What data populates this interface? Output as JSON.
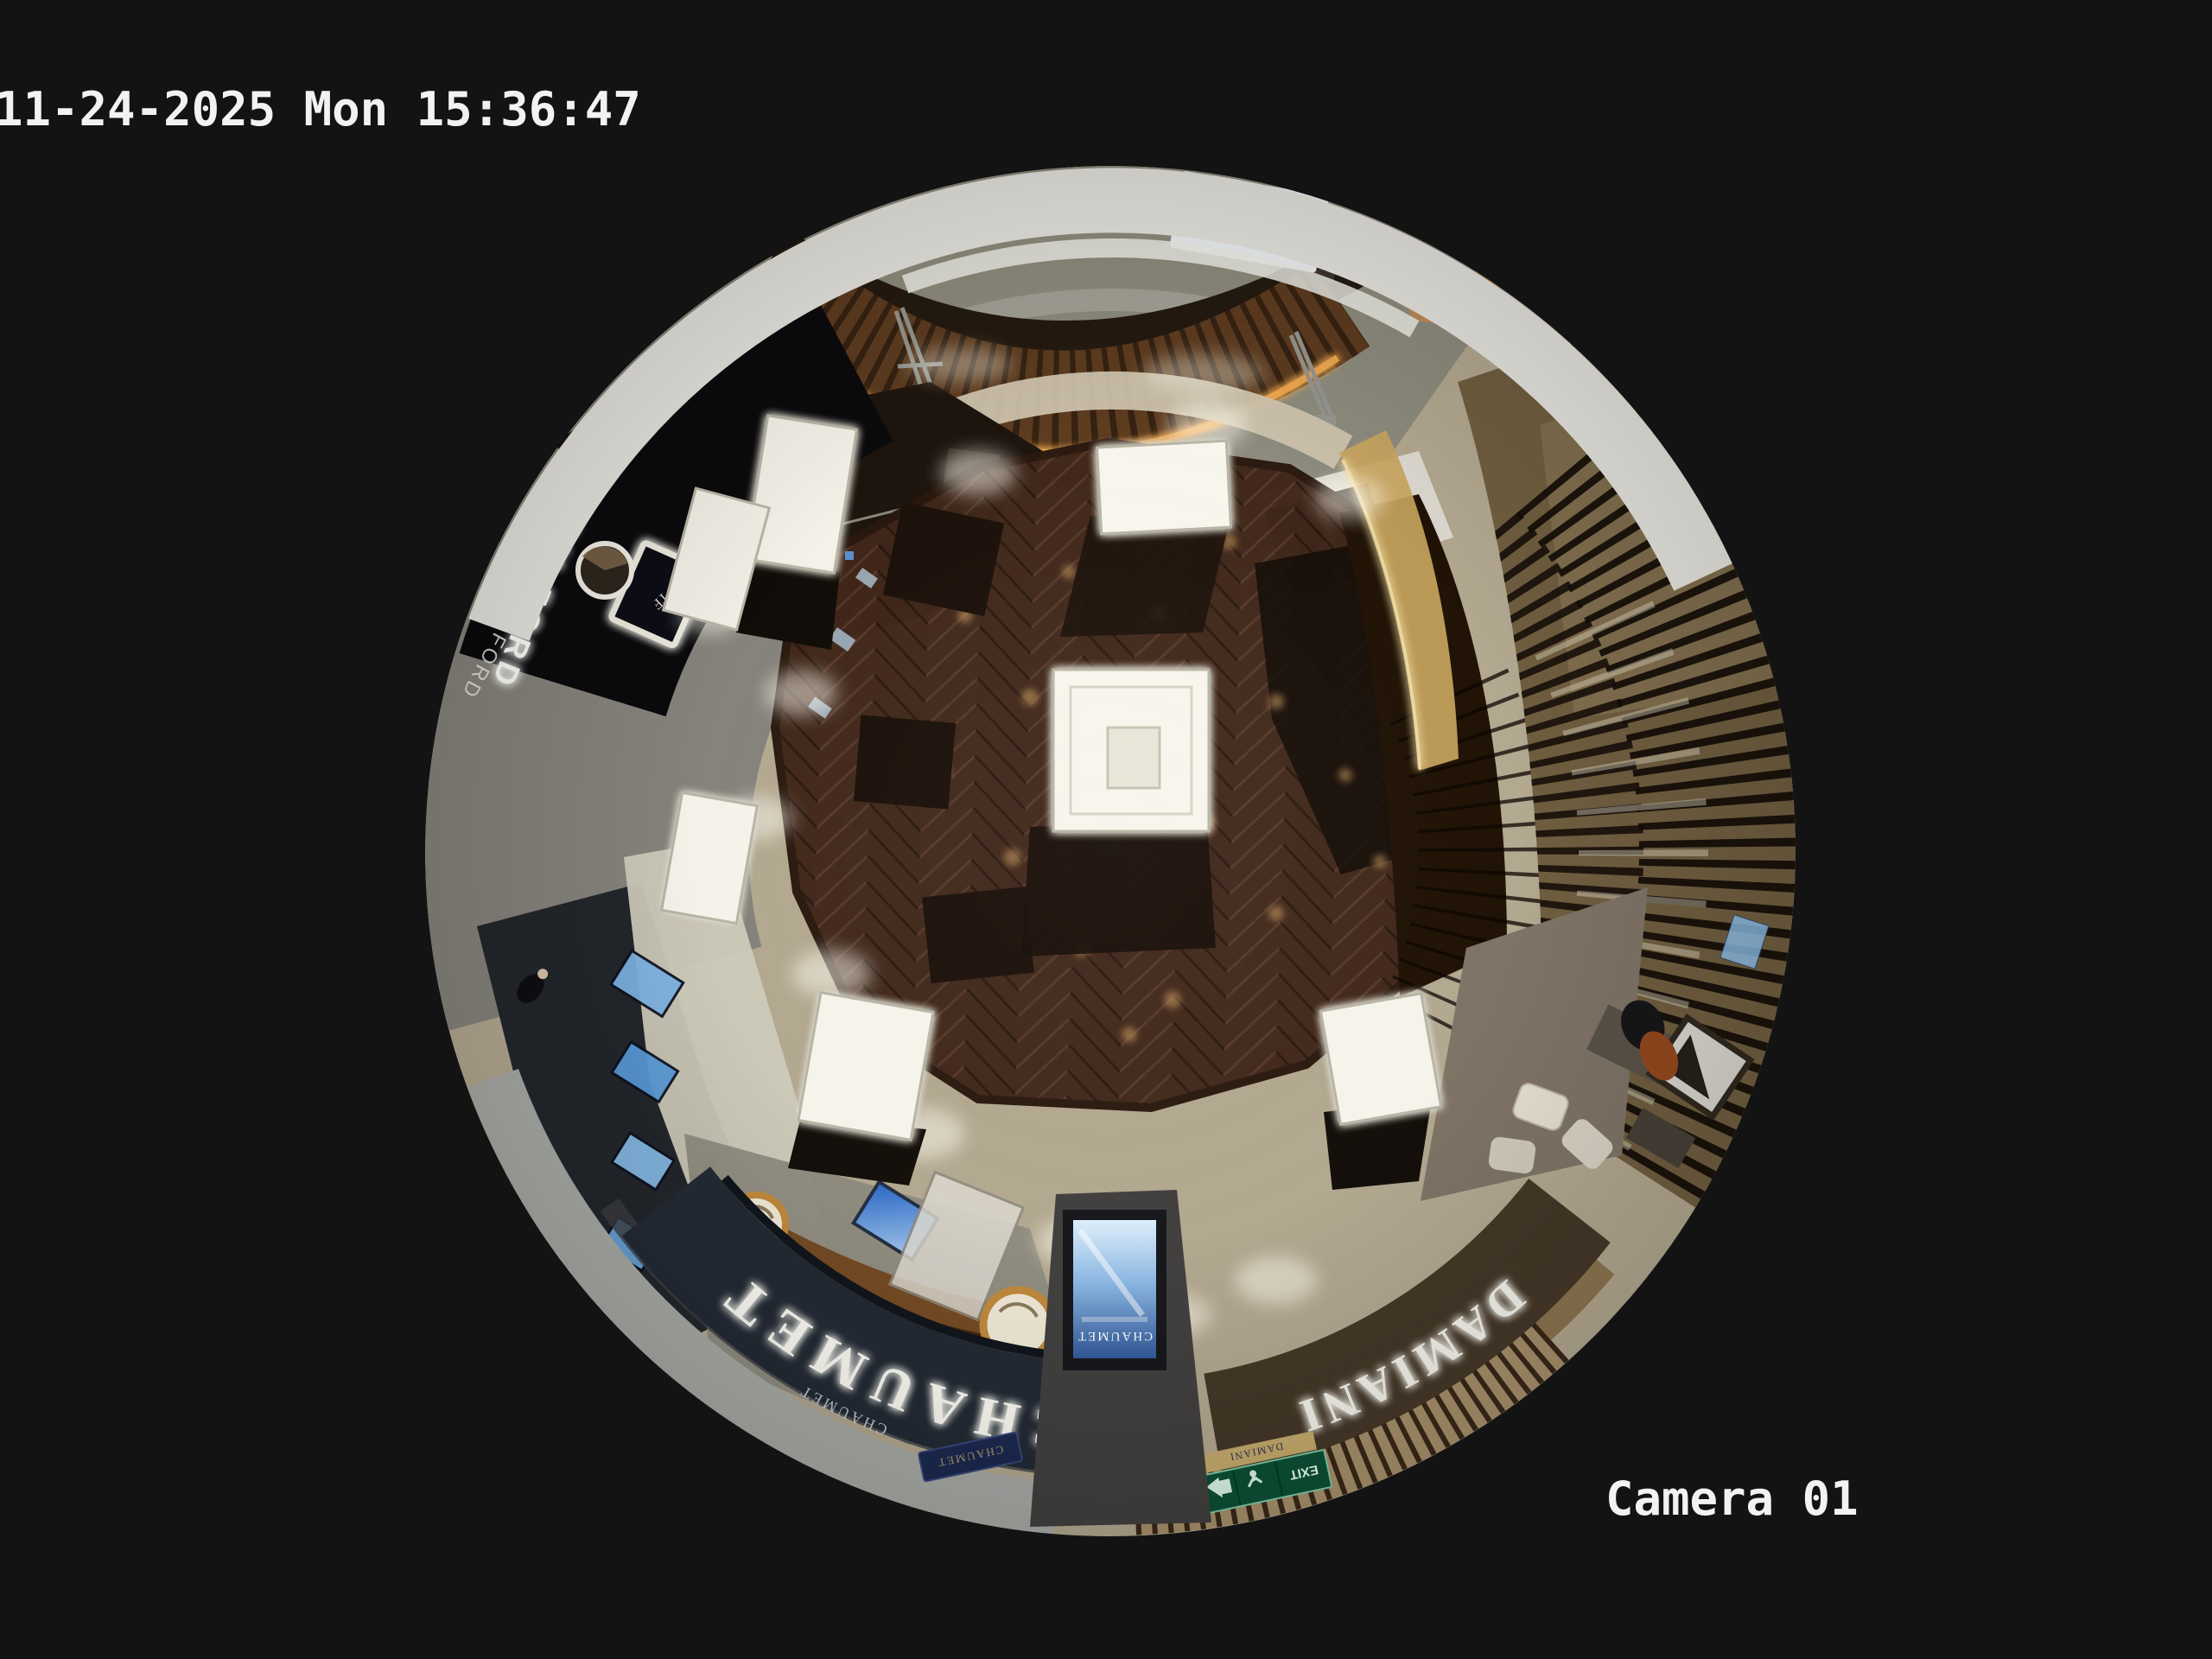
{
  "osd": {
    "timestamp": "11-24-2025 Mon 15:36:47",
    "camera_label": "Camera 01"
  },
  "signs": {
    "chaumet_fascia": "CHAUMET",
    "chaumet_small": "CHAUMET",
    "chaumet_plaque": "CHAUMET",
    "chaumet_screen_ad": "CHAUMET",
    "damiani_fascia": "DAMIANI",
    "damiani_small": "DAMIANI",
    "tom_ford_sign": "TOM FORD",
    "tom_ford_sign_2": "TOM FORD",
    "tf_monogram": "TF",
    "exit_sign": "EXIT"
  },
  "colors": {
    "frame_background": "#131313",
    "osd_text": "#f2f2f2",
    "herringbone_wood": "#412718",
    "store_walkway": "#b3a890",
    "corridor_marble": "#8d8b7d",
    "chaumet_fascia": "#242b35",
    "damiani_fascia": "#453828",
    "exit_green": "#0d5036",
    "ad_screen_blue": "#3f6db0",
    "kiosk_wood": "#5d3c20"
  }
}
